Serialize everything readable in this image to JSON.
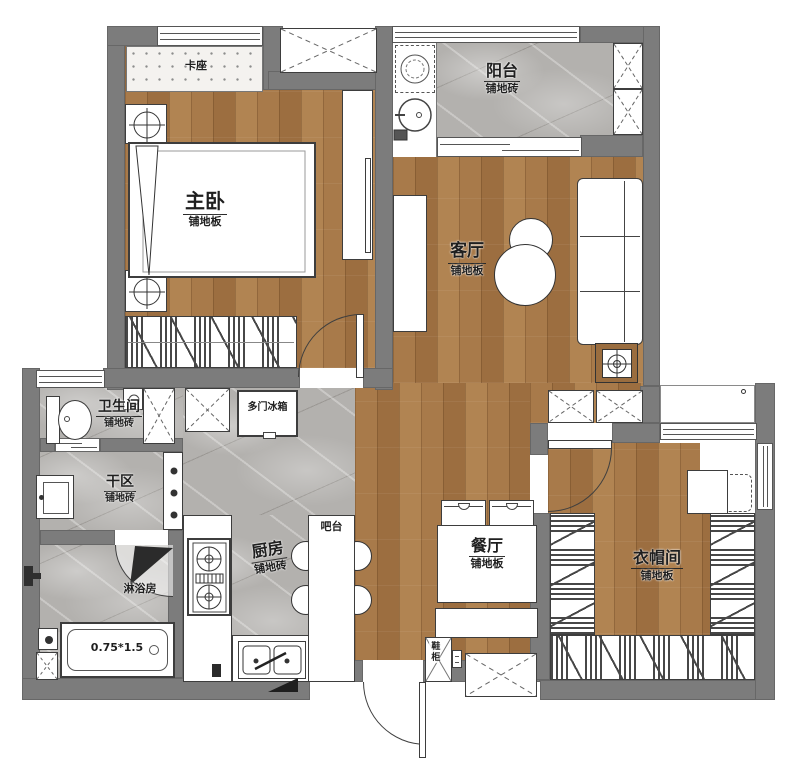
{
  "plan": {
    "rooms": [
      {
        "id": "master-bedroom",
        "name": "主卧",
        "floor": "铺地板"
      },
      {
        "id": "balcony",
        "name": "阳台",
        "floor": "铺地砖"
      },
      {
        "id": "living-room",
        "name": "客厅",
        "floor": "铺地板"
      },
      {
        "id": "bathroom",
        "name": "卫生间",
        "floor": "铺地砖"
      },
      {
        "id": "dry-area",
        "name": "干区",
        "floor": "铺地砖"
      },
      {
        "id": "kitchen",
        "name": "厨房",
        "floor": "铺地砖"
      },
      {
        "id": "dining-room",
        "name": "餐厅",
        "floor": "铺地板"
      },
      {
        "id": "cloakroom",
        "name": "衣帽间",
        "floor": "铺地板"
      }
    ],
    "fixtures": {
      "booth": "卡座",
      "fridge": "多门冰箱",
      "bar": "吧台",
      "shower_room": "淋浴房",
      "bathtub_size": "0.75*1.5",
      "shoe_cabinet": "鞋柜"
    },
    "colors": {
      "wall": "#7c7c7c",
      "wood": "#a87a4a",
      "tile": "#b3b1ae",
      "line": "#3f3f3f"
    }
  }
}
